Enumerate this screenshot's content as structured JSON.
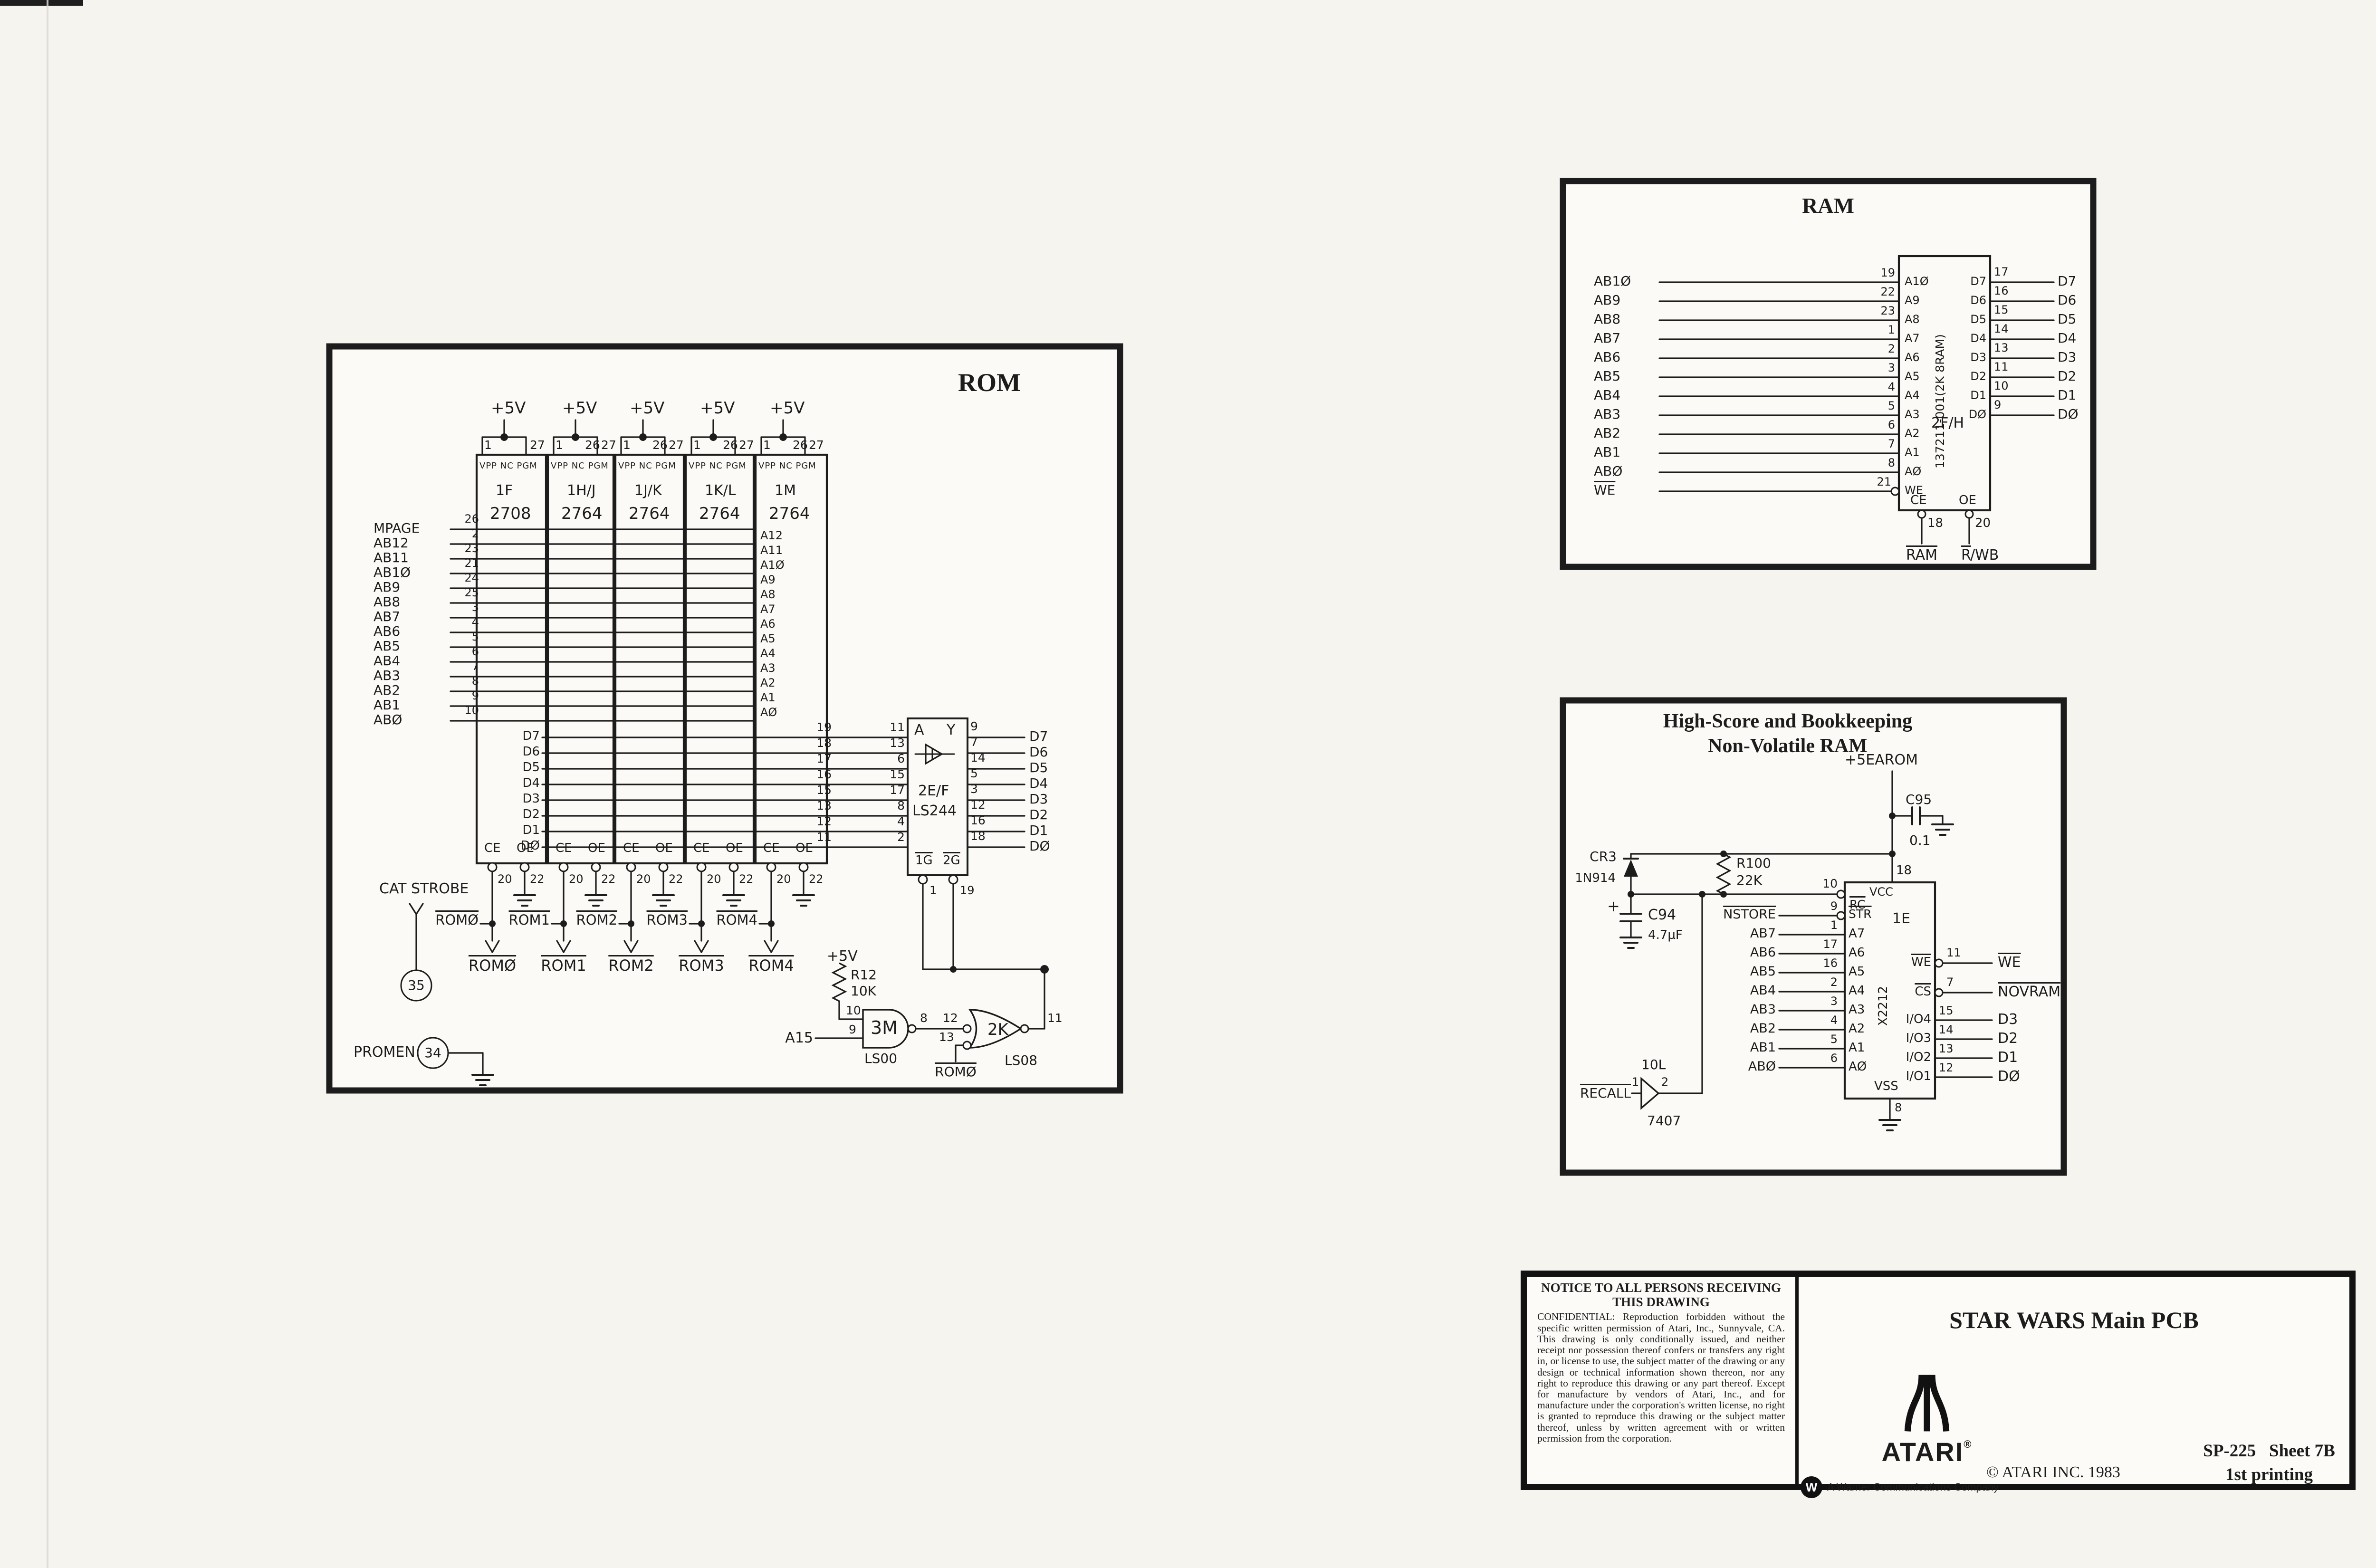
{
  "rom": {
    "title": "ROM",
    "plus5": "+5V",
    "chip_header": "VPP NC PGM",
    "chips": [
      {
        "name": "1F",
        "part": "2708",
        "p1": "1",
        "p26": "",
        "p27": "27"
      },
      {
        "name": "1H/J",
        "part": "2764",
        "p1": "1",
        "p26": "26",
        "p27": "27"
      },
      {
        "name": "1J/K",
        "part": "2764",
        "p1": "1",
        "p26": "26",
        "p27": "27"
      },
      {
        "name": "1K/L",
        "part": "2764",
        "p1": "1",
        "p26": "26",
        "p27": "27"
      },
      {
        "name": "1M",
        "part": "2764",
        "p1": "1",
        "p26": "26",
        "p27": "27"
      }
    ],
    "address_rows": [
      {
        "label": "MPAGE",
        "pin": "26"
      },
      {
        "label": "AB12",
        "pin": "2"
      },
      {
        "label": "AB11",
        "pin": "23"
      },
      {
        "label": "AB1Ø",
        "pin": "21"
      },
      {
        "label": "AB9",
        "pin": "24"
      },
      {
        "label": "AB8",
        "pin": "25"
      },
      {
        "label": "AB7",
        "pin": "3"
      },
      {
        "label": "AB6",
        "pin": "4"
      },
      {
        "label": "AB5",
        "pin": "5"
      },
      {
        "label": "AB4",
        "pin": "6"
      },
      {
        "label": "AB3",
        "pin": "7"
      },
      {
        "label": "AB2",
        "pin": "8"
      },
      {
        "label": "AB1",
        "pin": "9"
      },
      {
        "label": "ABØ",
        "pin": "10"
      }
    ],
    "m_addr": [
      "A12",
      "A11",
      "A1Ø",
      "A9",
      "A8",
      "A7",
      "A6",
      "A5",
      "A4",
      "A3",
      "A2",
      "A1",
      "AØ"
    ],
    "data_rows": [
      {
        "d": "D7",
        "rp": "19",
        "bi": "11",
        "bo": "9",
        "out": "D7"
      },
      {
        "d": "D6",
        "rp": "18",
        "bi": "13",
        "bo": "7",
        "out": "D6"
      },
      {
        "d": "D5",
        "rp": "17",
        "bi": "6",
        "bo": "14",
        "out": "D5"
      },
      {
        "d": "D4",
        "rp": "16",
        "bi": "15",
        "bo": "5",
        "out": "D4"
      },
      {
        "d": "D3",
        "rp": "15",
        "bi": "17",
        "bo": "3",
        "out": "D3"
      },
      {
        "d": "D2",
        "rp": "13",
        "bi": "8",
        "bo": "12",
        "out": "D2"
      },
      {
        "d": "D1",
        "rp": "12",
        "bi": "4",
        "bo": "16",
        "out": "D1"
      },
      {
        "d": "DØ",
        "rp": "11",
        "bi": "2",
        "bo": "18",
        "out": "DØ"
      }
    ],
    "buffer": {
      "a": "A",
      "y": "Y",
      "des": "2E/F",
      "part": "LS244",
      "g1": "1G",
      "g2": "2G",
      "g1pin": "1",
      "g2pin": "19"
    },
    "ce": "CE",
    "oe": "OE",
    "cepin": "20",
    "oepin": "22",
    "rom_sel": [
      "ROMØ",
      "ROM1",
      "ROM2",
      "ROM3",
      "ROM4"
    ],
    "cat_strobe": "CAT STROBE",
    "cat_circle": "35",
    "promen": "PROMEN",
    "promen_circle": "34",
    "gate": {
      "plus5": "+5V",
      "r": "R12",
      "rv": "10K",
      "p10": "10",
      "p9": "9",
      "p8": "8",
      "nand": "3M",
      "nandpart": "LS00",
      "p12": "12",
      "p13": "13",
      "and": "2K",
      "andpart": "LS08",
      "p11": "11",
      "a15": "A15",
      "rom0": "ROMØ"
    }
  },
  "ram": {
    "title": "RAM",
    "addr": [
      {
        "label": "AB1Ø",
        "pin": "19",
        "chip": "A1Ø"
      },
      {
        "label": "AB9",
        "pin": "22",
        "chip": "A9"
      },
      {
        "label": "AB8",
        "pin": "23",
        "chip": "A8"
      },
      {
        "label": "AB7",
        "pin": "1",
        "chip": "A7"
      },
      {
        "label": "AB6",
        "pin": "2",
        "chip": "A6"
      },
      {
        "label": "AB5",
        "pin": "3",
        "chip": "A5"
      },
      {
        "label": "AB4",
        "pin": "4",
        "chip": "A4"
      },
      {
        "label": "AB3",
        "pin": "5",
        "chip": "A3"
      },
      {
        "label": "AB2",
        "pin": "6",
        "chip": "A2"
      },
      {
        "label": "AB1",
        "pin": "7",
        "chip": "A1"
      },
      {
        "label": "ABØ",
        "pin": "8",
        "chip": "AØ"
      }
    ],
    "we": {
      "label": "WE",
      "pin": "21",
      "chip": "WE"
    },
    "part_vertical": "137211-001(2K 8RAM)",
    "designator": "2F/H",
    "data": [
      {
        "chip": "D7",
        "pin": "17",
        "out": "D7"
      },
      {
        "chip": "D6",
        "pin": "16",
        "out": "D6"
      },
      {
        "chip": "D5",
        "pin": "15",
        "out": "D5"
      },
      {
        "chip": "D4",
        "pin": "14",
        "out": "D4"
      },
      {
        "chip": "D3",
        "pin": "13",
        "out": "D3"
      },
      {
        "chip": "D2",
        "pin": "11",
        "out": "D2"
      },
      {
        "chip": "D1",
        "pin": "10",
        "out": "D1"
      },
      {
        "chip": "DØ",
        "pin": "9",
        "out": "DØ"
      }
    ],
    "ce": "CE",
    "cepin": "18",
    "ce_sig": "RAM",
    "oe": "OE",
    "oepin": "20",
    "oe_sig_r": "R",
    "oe_sig_rest": "/WB"
  },
  "nvram": {
    "title1": "High-Score and Bookkeeping",
    "title2": "Non-Volatile RAM",
    "supply": "+5EAROM",
    "c95": "C95",
    "c95v": "0.1",
    "cr3": "CR3",
    "cr3v": "1N914",
    "r100": "R100",
    "r100v": "22K",
    "plus": "+",
    "c94": "C94",
    "c94v": "4.7µF",
    "rc_pin": "10",
    "left": [
      {
        "label": "NSTORE",
        "pin": "9"
      },
      {
        "label": "AB7",
        "pin": "1"
      },
      {
        "label": "AB6",
        "pin": "17"
      },
      {
        "label": "AB5",
        "pin": "16"
      },
      {
        "label": "AB4",
        "pin": "2"
      },
      {
        "label": "AB3",
        "pin": "3"
      },
      {
        "label": "AB2",
        "pin": "4"
      },
      {
        "label": "AB1",
        "pin": "5"
      },
      {
        "label": "ABØ",
        "pin": "6"
      }
    ],
    "chip": {
      "vcc": "VCC",
      "vccpin": "18",
      "rc": "RC",
      "str": "STR",
      "des": "1E",
      "part": "X2212",
      "addr": [
        "A7",
        "A6",
        "A5",
        "A4",
        "A3",
        "A2",
        "A1",
        "AØ"
      ],
      "vss": "VSS",
      "vsspin": "8",
      "we": "WE",
      "cs": "CS",
      "io": [
        "I/O4",
        "I/O3",
        "I/O2",
        "I/O1"
      ]
    },
    "right": [
      {
        "pin": "11",
        "label": "WE"
      },
      {
        "pin": "7",
        "label": "NOVRAM"
      }
    ],
    "data_out": [
      {
        "pin": "15",
        "label": "D3"
      },
      {
        "pin": "14",
        "label": "D2"
      },
      {
        "pin": "13",
        "label": "D1"
      },
      {
        "pin": "12",
        "label": "DØ"
      }
    ],
    "recall": {
      "label": "RECALL",
      "p1": "1",
      "p2": "2",
      "des": "10L",
      "part": "7407"
    }
  },
  "titleblock": {
    "notice_title1": "NOTICE TO ALL PERSONS RECEIVING",
    "notice_title2": "THIS DRAWING",
    "notice_body": "CONFIDENTIAL: Reproduction forbidden without the specific written permission of Atari, Inc., Sunnyvale, CA. This drawing is only conditionally issued, and neither receipt nor possession thereof confers or transfers any right in, or license to use, the subject matter of the drawing or any design or technical information shown thereon, nor any right to reproduce this drawing or any part thereof. Except for manufacture by vendors of Atari, Inc., and for manufacture under the corporation's written license, no right is granted to reproduce this drawing or the subject matter thereof, unless by written agreement with or written permission from the corporation.",
    "product": "STAR WARS Main PCB",
    "brand": "ATARI",
    "reg": "®",
    "copyright": "© ATARI INC. 1983",
    "doc_number": "SP-225",
    "sheet": "Sheet 7B",
    "printing": "1st printing",
    "warner_w": "W",
    "warner": "A Warner Communications Company"
  }
}
